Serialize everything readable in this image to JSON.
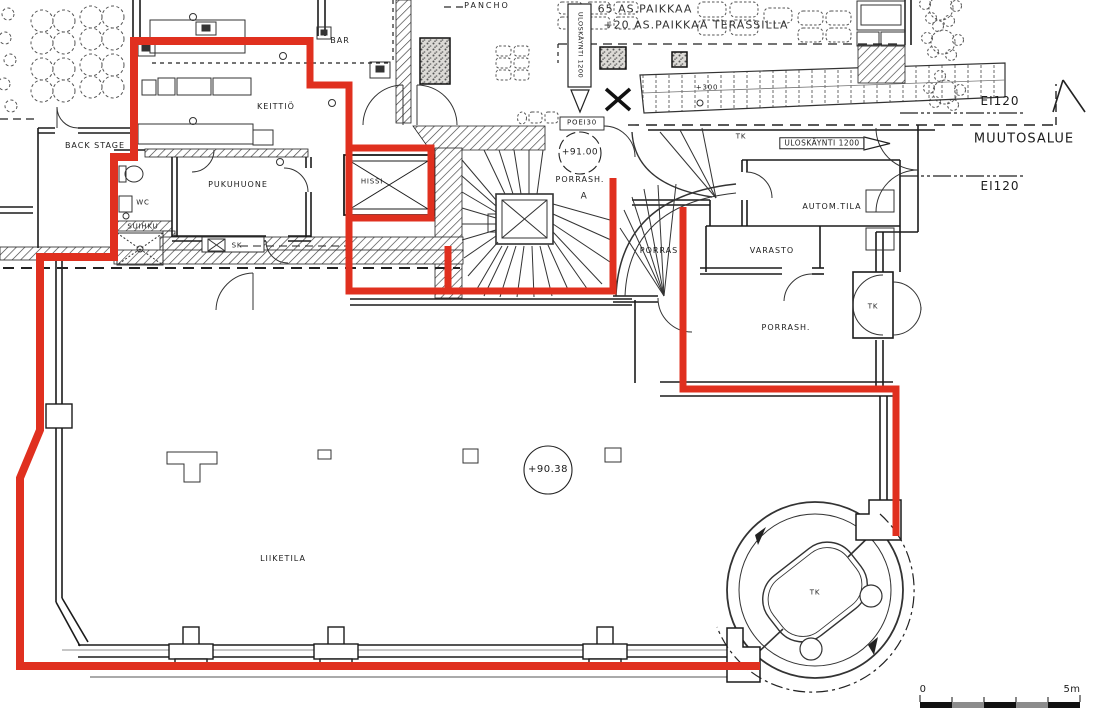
{
  "labels": {
    "pancho": "PANCHO",
    "bar": "BAR",
    "keittio": "KEITTIÖ",
    "back_stage": "BACK STAGE",
    "pukuhuone": "PUKUHUONE",
    "wc": "WC",
    "suihku": "SUIHKU",
    "sk": "SK",
    "hissi": "HISSI",
    "uloskaynti_vertical": "ULOSKÄYNTI 1200",
    "seats_line1": "65 AS.PAIKKAA",
    "seats_line2": "+20 AS.PAIKKAA TERASSILLA",
    "plus300": "+300",
    "po_ei30": "POEI30",
    "level_upper": "+91.00",
    "porrash_a": "PORRASH.",
    "porrash_a_letter": "A",
    "tk_corridor": "TK",
    "uloskaynti_horizontal": "ULOSKÄYNTI 1200",
    "ei120_top": "EI120",
    "muutosalue": "MUUTOSALUE",
    "ei120_bottom": "EI120",
    "autom_tila": "AUTOM.TILA",
    "porras": "PORRAS",
    "varasto": "VARASTO",
    "tk_closet": "TK",
    "porrash_lower": "PORRASH.",
    "level_lower": "+90.38",
    "liiketila": "LIIKETILA",
    "tk_tower": "TK",
    "scale_zero": "0",
    "scale_five": "5m"
  },
  "colors": {
    "fire_boundary_red": "#e0301f",
    "wall_black": "#1b1b1b",
    "scale_gray": "#8c8c8c"
  }
}
